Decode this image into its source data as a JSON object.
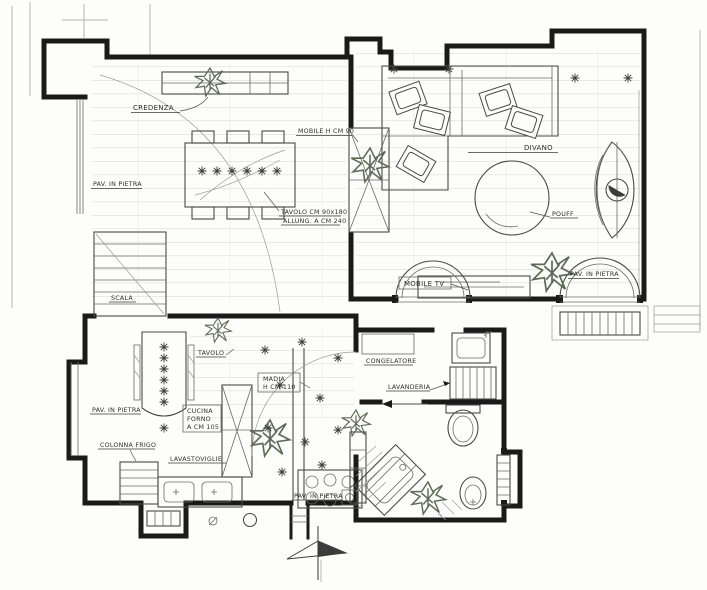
{
  "drawing": {
    "kind": "hand-drawn apartment floor plan sketch",
    "colors": {
      "paper": "#fdfdfb",
      "ink": "#1a1a1a",
      "pencil": "#9b9b96",
      "plant": "#5c6b54"
    }
  },
  "labels": {
    "credenza": "CREDENZA",
    "pav_pietra_dining": "PAV. IN PIETRA",
    "mobile_h90": "MOBILE H CM 90",
    "tavolo_line1": "TAVOLO CM 90x180",
    "tavolo_line2": "ALLUNG. A CM 240",
    "divano": "DIVANO",
    "pouff": "POUFF",
    "mobile_tv": "MOBILE TV",
    "pav_pietra_living": "PAV. IN PIETRA",
    "scala": "SCALA",
    "tavolo_cucina": "TAVOLO",
    "madia_line1": "MADIA",
    "madia_line2": "H CM 110",
    "pav_pietra_kitchen": "PAV. IN PIETRA",
    "colonna_frigo": "COLONNA FRIGO",
    "lavastoviglie": "LAVASTOVIGLIE",
    "forno_line1": "CUCINA",
    "forno_line2": "FORNO",
    "forno_line3": "A CM 105",
    "pav_pietra_hall": "PAV. IN PIETRA",
    "congelatore": "CONGELATORE",
    "lavanderia": "LAVANDERIA"
  }
}
